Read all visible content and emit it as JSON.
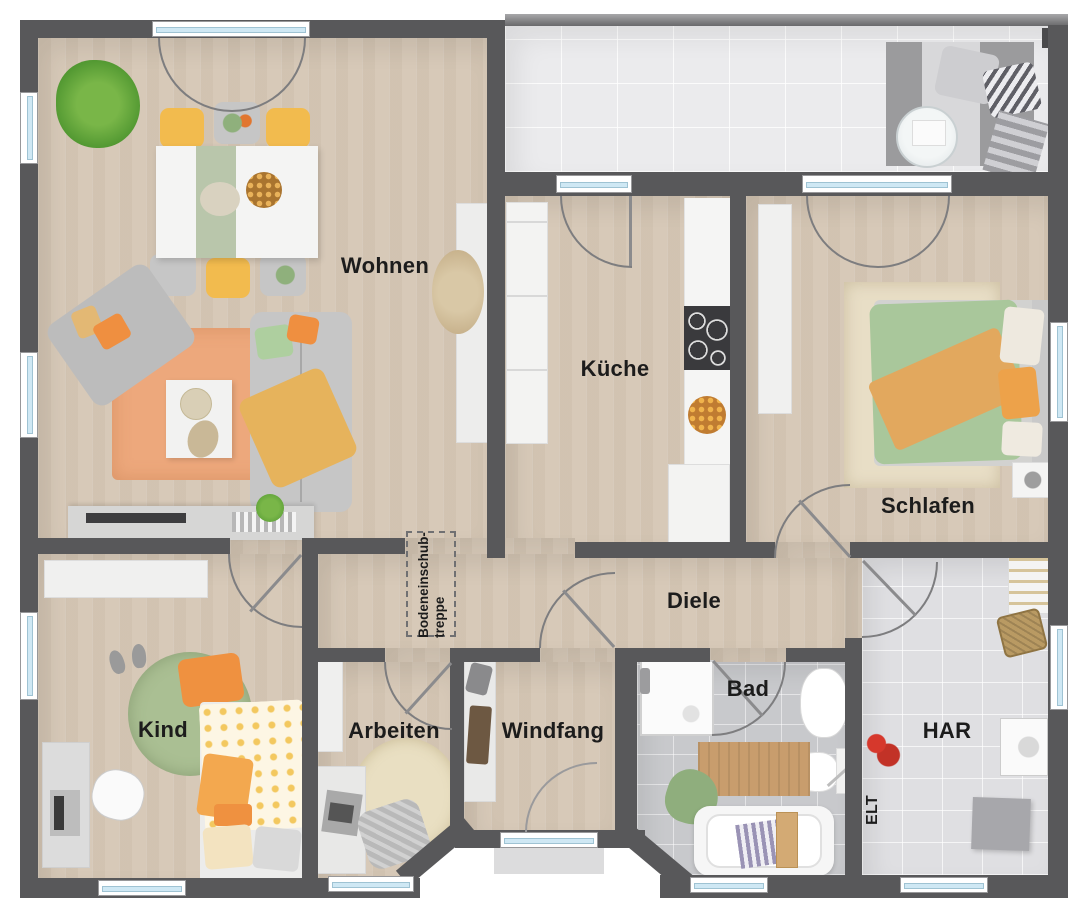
{
  "plan": {
    "type": "floor-plan-top-view",
    "rooms": {
      "wohnen": {
        "label": "Wohnen"
      },
      "kueche": {
        "label": "Küche"
      },
      "schlafen": {
        "label": "Schlafen"
      },
      "diele": {
        "label": "Diele"
      },
      "kind": {
        "label": "Kind"
      },
      "arbeiten": {
        "label": "Arbeiten"
      },
      "windfang": {
        "label": "Windfang"
      },
      "bad": {
        "label": "Bad"
      },
      "har": {
        "label": "HAR"
      },
      "elt": {
        "label": "ELT"
      },
      "treppe": {
        "line1": "Bodeneinschub-",
        "line2": "treppe"
      }
    },
    "colors": {
      "wall": "#58585a",
      "wood_floor": "#d7c9b8",
      "terrace_tile": "#ebebed",
      "bath_tile": "#c8c9cc",
      "har_tile": "#dfdfe2",
      "window_glass": "#cfe8f4",
      "door_arc": "#7d7d7f",
      "accent_orange": "#ef9142",
      "accent_yellow": "#f2bb4e",
      "accent_green": "#a9c498",
      "rug_orange": "#eda87c",
      "label_text": "#1c1c1c"
    }
  }
}
